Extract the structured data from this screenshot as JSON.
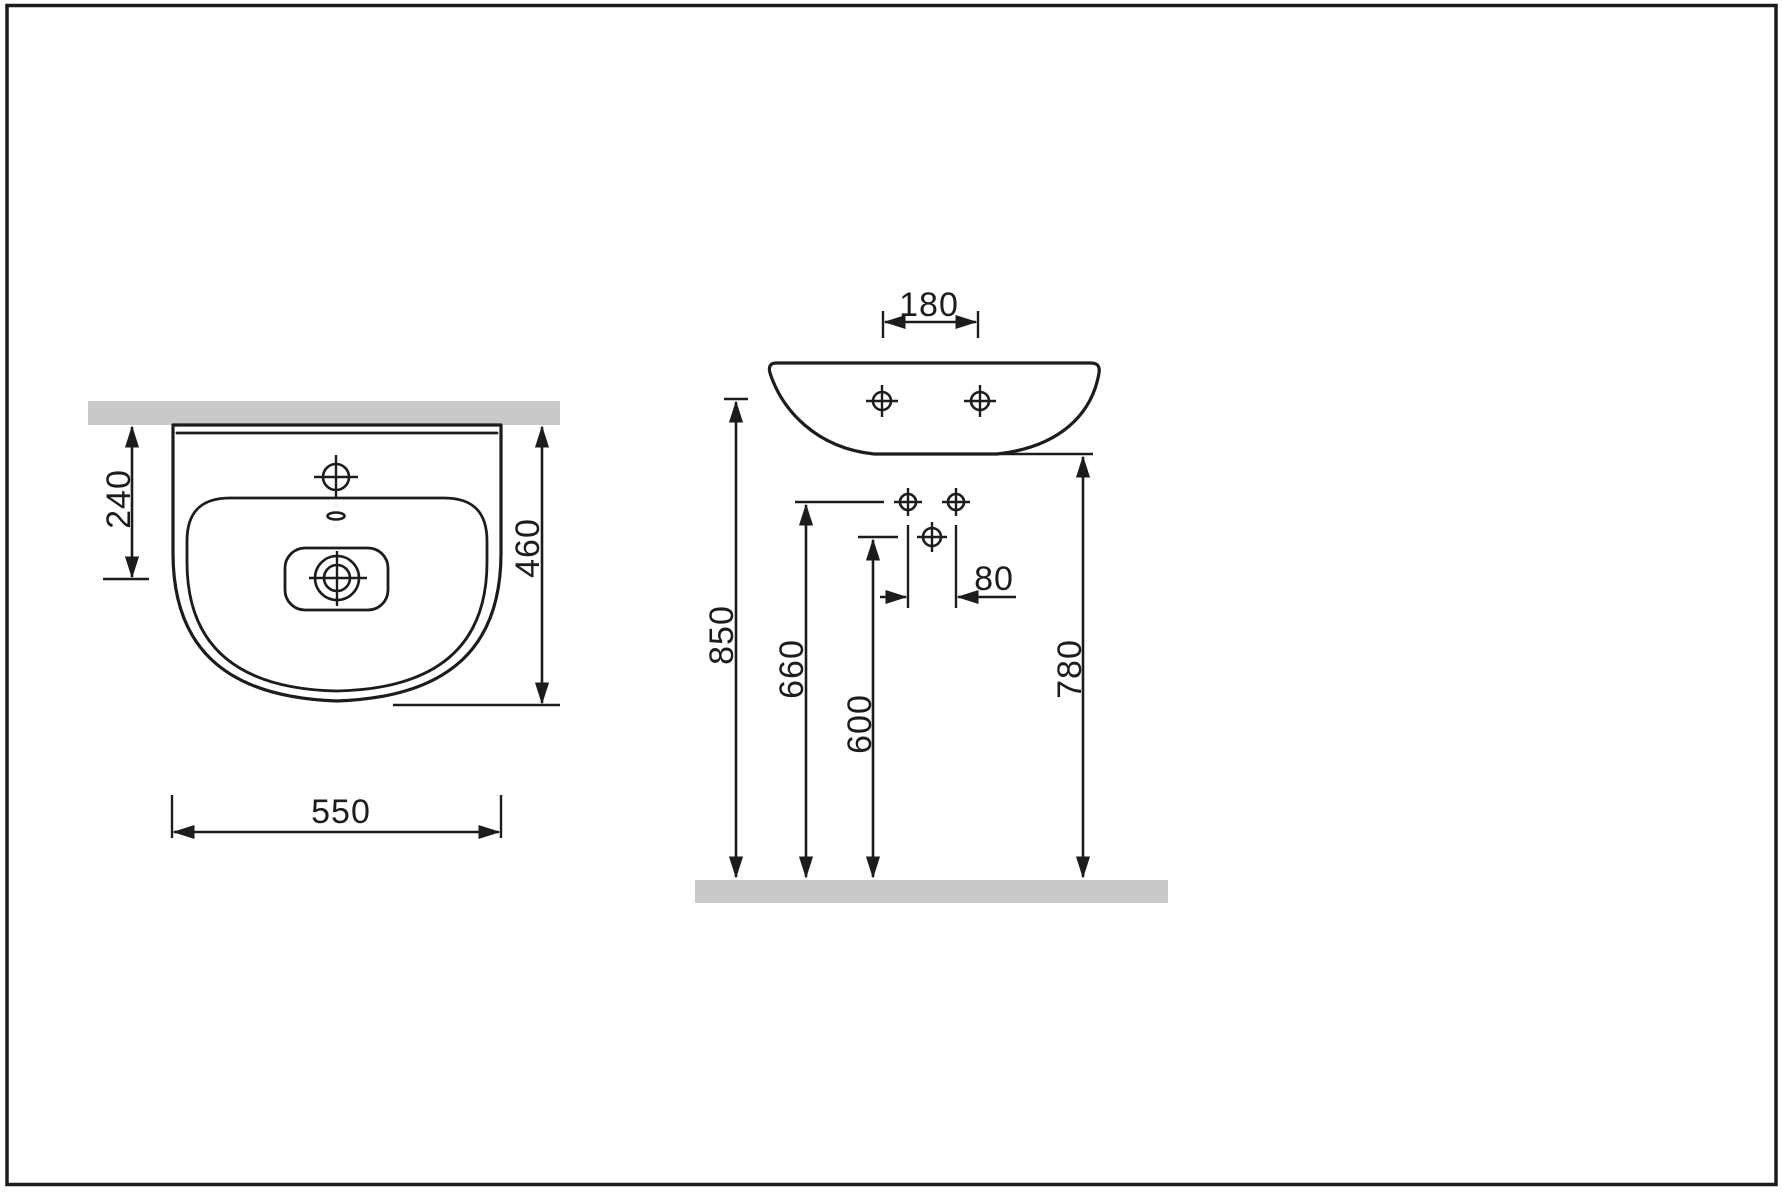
{
  "diagram": {
    "kind": "washbasin-dimension-drawing",
    "colors": {
      "line": "#1c1c1c",
      "surface_fill": "#c9c9c9",
      "background": "#ffffff"
    },
    "top_view": {
      "overall_width": "550",
      "overall_depth": "460",
      "wall_to_drain_center": "240"
    },
    "front_view": {
      "fixing_hole_spacing": "180",
      "fitting_hole_spacing": "80",
      "rim_height": "850",
      "fitting_holes_height": "660",
      "drain_height": "600",
      "underside_height": "780"
    }
  }
}
